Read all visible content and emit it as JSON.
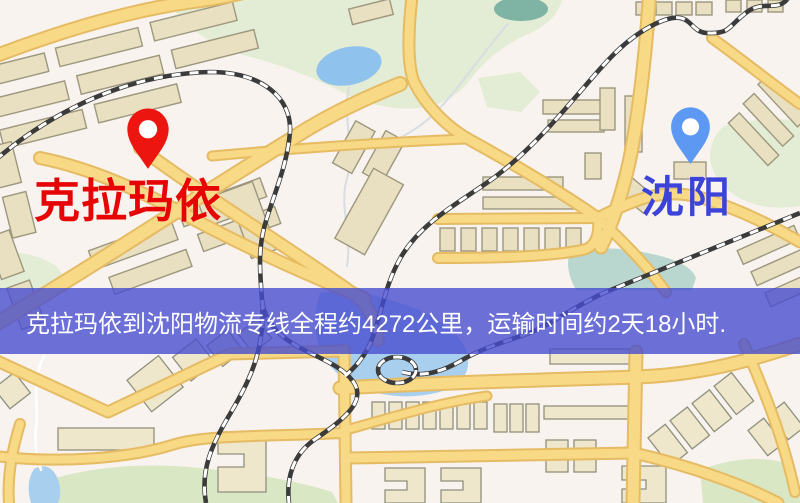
{
  "route": {
    "origin": "克拉玛依",
    "destination": "沈阳",
    "distance_text": "约4272公里",
    "duration_text": "约2天18小时"
  },
  "origin_marker": {
    "label": "克拉玛依",
    "pin_color": "#ec1510",
    "pin_hole_color": "#ffffff",
    "label_color": "#e60404"
  },
  "destination_marker": {
    "label": "沈阳",
    "pin_color": "#5d98f2",
    "pin_hole_color": "#ffffff",
    "label_color": "#3c43d9"
  },
  "banner": {
    "text": "克拉玛依到沈阳物流专线全程约4272公里，运输时间约2天18小时.",
    "background_color": "rgba(71,77,208,0.8)",
    "text_color": "#ffffff"
  },
  "map_style": {
    "background": "#f8f3ee",
    "road_fill": "#f8d985",
    "road_casing": "#e5bb63",
    "building_fill": "#e9e0c2",
    "park_fill": "#e3ecd4",
    "water_fill": "#a9cfee",
    "railway_color": "#3b3b3b"
  }
}
